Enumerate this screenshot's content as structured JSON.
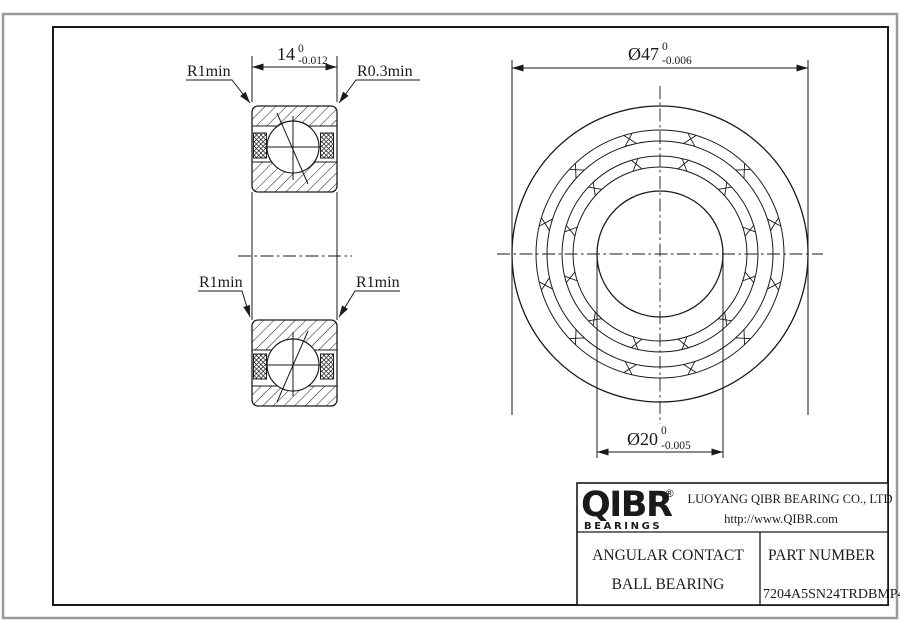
{
  "drawing": {
    "side_view": {
      "width_dim": {
        "value": "14",
        "tol_upper": "0",
        "tol_lower": "-0.012"
      },
      "fillet_top_left": "R1min",
      "fillet_top_right": "R0.3min",
      "fillet_mid_left": "R1min",
      "fillet_mid_right": "R1min"
    },
    "front_view": {
      "outer_dia_dim": {
        "value": "Ø47",
        "tol_upper": "0",
        "tol_lower": "-0.006"
      },
      "bore_dia_dim": {
        "value": "Ø20",
        "tol_upper": "0",
        "tol_lower": "-0.005"
      }
    }
  },
  "title_block": {
    "logo_text": "QIBR",
    "logo_registered": "®",
    "logo_subtext": "BEARINGS",
    "company": "LUOYANG QIBR BEARING CO., LTD",
    "website": "http://www.QIBR.com",
    "product_line1": "ANGULAR CONTACT",
    "product_line2": "BALL BEARING",
    "part_number_label": "PART NUMBER",
    "part_number": "7204A5SN24TRDBMP4"
  },
  "colors": {
    "line": "#1a1a1a",
    "outer_border": "#9a9a9a",
    "background": "#ffffff"
  }
}
